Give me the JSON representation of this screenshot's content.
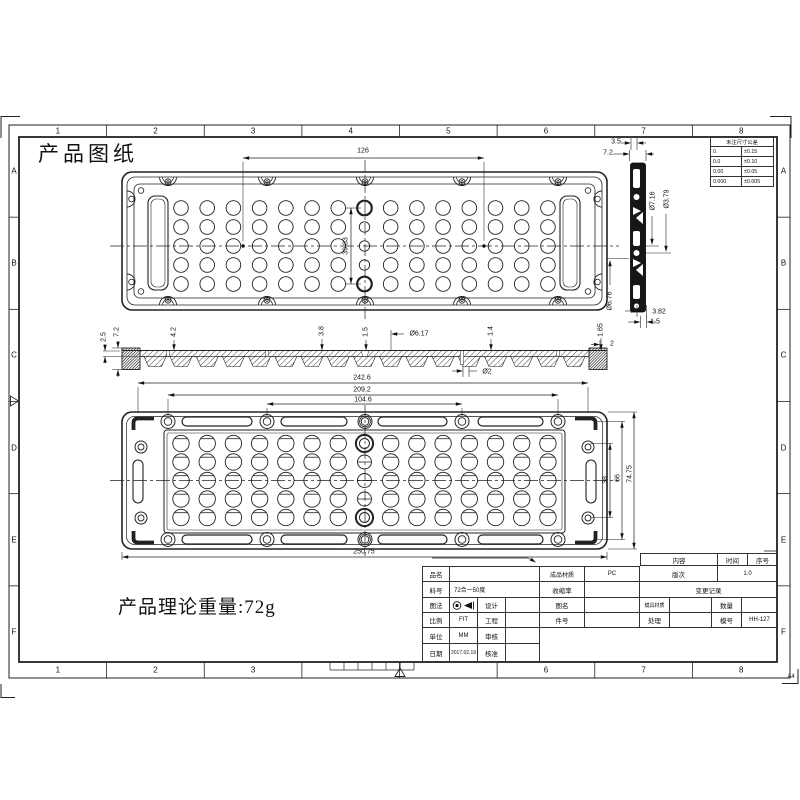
{
  "sheet": {
    "title": "产品图纸",
    "weight_note": "产品理论重量:72g",
    "paper_size_label": "A4",
    "zone_columns": [
      "1",
      "2",
      "3",
      "4",
      "5",
      "6",
      "7",
      "8"
    ],
    "zone_rows": [
      "A",
      "B",
      "C",
      "D",
      "E",
      "F"
    ]
  },
  "tolerance_table": {
    "header": "未注尺寸公差",
    "rows": [
      [
        "0.",
        "±0.15"
      ],
      [
        "0.0",
        "±0.10"
      ],
      [
        "0.00",
        "±0.05"
      ],
      [
        "0.000",
        "±0.005"
      ]
    ]
  },
  "part": {
    "lens_grid": {
      "columns": 15,
      "rows": 5
    }
  },
  "views": {
    "top_view": {
      "dims": {
        "hole_pitch_x": "126",
        "hole_pitch_y": "39.83"
      }
    },
    "section_view": {
      "dims": {
        "base_thickness": "2.5",
        "total_height": "7.2",
        "rib_height": "4.2",
        "lens_height": "3.8",
        "step_1": "1.5",
        "lens_dia": "Ø6.17",
        "step_2": "1.4",
        "edge_step": "1.65",
        "edge_width": "2",
        "hole_dia": "Ø2"
      }
    },
    "bottom_view": {
      "dims": {
        "slot_span": "242.6",
        "outer_hole_pitch": "209.2",
        "inner_hole_pitch": "104.6",
        "total_width": "250.75",
        "lens_span": "38",
        "hole_span": "66",
        "total_height": "74.75"
      }
    },
    "side_view": {
      "dims": {
        "top_step": "3.5",
        "thickness": "7.2",
        "bore_dia_1": "Ø7.16",
        "bore_dia_2": "Ø3.79",
        "bore_dia_3": "Ø6.76",
        "bottom_step": "3.82",
        "edge": "1.5"
      }
    }
  },
  "title_block": {
    "product_name_label": "品名",
    "part_no_label": "料号",
    "part_no": "72合一50度",
    "projection_label": "图法",
    "design_label": "设计",
    "scale_label": "比例",
    "scale": "FIT",
    "engineering_label": "工程",
    "unit_label": "单位",
    "unit": "MM",
    "review_label": "审核",
    "date_label": "日期",
    "date": "2017.02.19",
    "approve_label": "核准",
    "material_label": "成品材质",
    "material": "PC",
    "shrinkage_label": "收缩率",
    "drawing_name_label": "图名",
    "item_no_label": "件号",
    "content_label": "内容",
    "time_label": "时间",
    "serial_label": "序号",
    "revision_label": "版次",
    "revision": "1.0",
    "change_record_label": "变更记录",
    "mold_material_label": "模具材质",
    "quantity_label": "数量",
    "treatment_label": "处理",
    "mold_no_label": "模号",
    "mold_no": "HH-127"
  }
}
